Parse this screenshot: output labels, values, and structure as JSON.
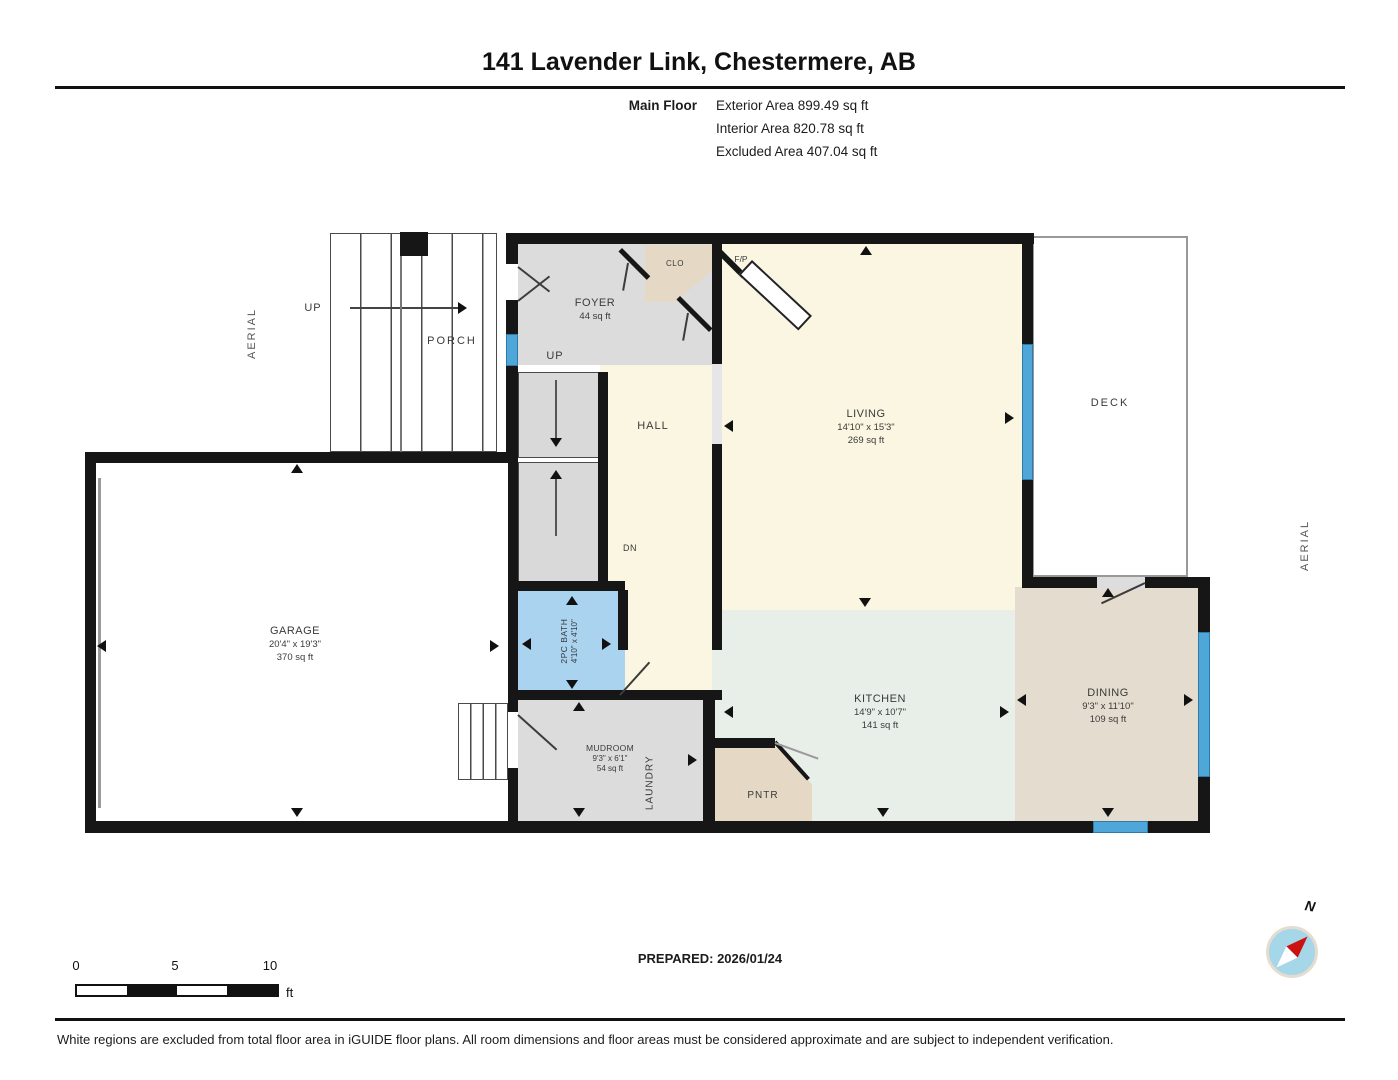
{
  "header": {
    "title": "141 Lavender Link, Chestermere, AB",
    "floor_label": "Main Floor",
    "stats": [
      "Exterior Area 899.49 sq ft",
      "Interior Area 820.78 sq ft",
      "Excluded Area 407.04 sq ft"
    ]
  },
  "rooms": {
    "living": {
      "name": "LIVING",
      "dims": "14'10\" x 15'3\"",
      "area": "269 sq ft"
    },
    "kitchen": {
      "name": "KITCHEN",
      "dims": "14'9\" x 10'7\"",
      "area": "141 sq ft"
    },
    "dining": {
      "name": "DINING",
      "dims": "9'3\" x 11'10\"",
      "area": "109 sq ft"
    },
    "garage": {
      "name": "GARAGE",
      "dims": "20'4\" x 19'3\"",
      "area": "370 sq ft"
    },
    "foyer": {
      "name": "FOYER",
      "area": "44 sq ft"
    },
    "mudroom": {
      "name": "MUDROOM",
      "dims": "9'3\" x 6'1\"",
      "area": "54 sq ft"
    },
    "bath": {
      "name": "2PC BATH",
      "dims": "4'10\" x 4'10\""
    },
    "hall": {
      "name": "HALL"
    },
    "laundry": {
      "name": "LAUNDRY"
    },
    "pantry": {
      "name": "PNTR"
    },
    "closet": {
      "name": "CLO"
    },
    "fireplace": {
      "name": "F/P"
    },
    "porch": {
      "name": "PORCH"
    },
    "deck": {
      "name": "DECK"
    }
  },
  "annotations": {
    "aerial_left": "AERIAL",
    "aerial_right": "AERIAL",
    "up_exterior": "UP",
    "up_interior": "UP",
    "down": "DN",
    "north": "N"
  },
  "scale_bar": {
    "ticks": [
      "0",
      "5",
      "10"
    ],
    "unit": "ft"
  },
  "footer": {
    "prepared": "PREPARED: 2026/01/24",
    "disclaimer": "White regions are excluded from total floor area in iGUIDE floor plans. All room dimensions and floor areas must be considered approximate and are subject to independent verification."
  },
  "colors": {
    "wall": "#161616",
    "window": "#4fa6d8",
    "interior_cream": "#faf6e1",
    "kitchen_mint": "#e8efe9",
    "dining_tan": "#e4dcce",
    "closet_tan": "#e5d8c4",
    "gray_room": "#dcdcdc",
    "bath_blue": "#a9d3ef",
    "compass_blue": "#a6d7e8",
    "compass_red": "#cc1111"
  }
}
